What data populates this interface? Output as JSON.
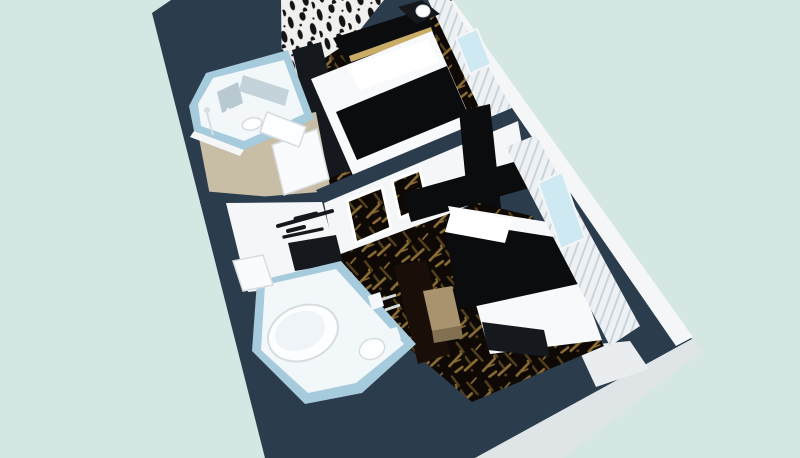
{
  "meta": {
    "description": "3D cutaway dollhouse rendering of a two-room hotel suite floor plan, viewed from above at an angle. No text is visible in the image.",
    "view": "aerial isometric cutaway",
    "width_px": 800,
    "height_px": 458
  },
  "palette": {
    "background": "#d4e7e2",
    "wall_top": "#2b3c4d",
    "slab_edge": "#dfe4e7",
    "notch_face": "#e9edef",
    "face_white": "#f4f6f8",
    "bathroom_wall": "#a6cbdc",
    "bathroom_floor": "#f2f7fa",
    "mirror": "#b9c9d1",
    "mirror_light": "#c4d3d9",
    "fixture_white": "#fdfeff",
    "fixture_line": "#d6dde1",
    "corridor_floor": "#c8bda5",
    "door_white": "#fafbfc",
    "door_edge": "#d8dde0",
    "carpet_base": "#0e0905",
    "carpet_motif1": "#8a6c34",
    "carpet_motif2": "#54401d",
    "wallpaper_bg": "#f0f0ee",
    "wallpaper_ink": "#141414",
    "bed_white": "#f7f9fa",
    "bed_black": "#0b0c0e",
    "pillow": "#ffffff",
    "trim_gold": "#c9ad67",
    "furniture_dark": "#15181c",
    "furniture_espresso": "#190f08",
    "stool_gray": "#23282d",
    "bench_tan_top": "#a8936e",
    "bench_tan_side": "#837050",
    "curtain": "#eef1f4",
    "curtain_line": "#c7d1d7",
    "window_glass": "#cfe9f2"
  },
  "scene": {
    "building": "two-room suite with dark navy wall tops and stepped lower-right corner",
    "rooms": [
      {
        "name": "guest room 1 (upper)",
        "floor": "black and gold patterned carpet",
        "wall_feature": "black-and-white birch patterned wallpaper",
        "furniture": [
          "bed with black runner and white linens",
          "black headboard with gold trim",
          "nightstand with white lamp",
          "dark wardrobe",
          "ottoman",
          "foot bench"
        ],
        "window": "curtained window on right wall"
      },
      {
        "name": "guest room 2 (lower)",
        "floor": "black and gold patterned carpet",
        "wall_feature": "black cross-shaped headboard art on divider wall, two framed prints, wall hanger rack, wall-mounted TV",
        "furniture": [
          "bed with black duvet and white foot blanket",
          "footboard bench",
          "espresso dresser",
          "tan luggage bench"
        ],
        "window": "curtained window on right wall"
      }
    ],
    "bathrooms": [
      {
        "name": "bathroom 1 (upper left)",
        "walls": "pale blue",
        "fixtures": [
          "vanity mirror",
          "sink",
          "tub",
          "shower"
        ]
      },
      {
        "name": "bathroom 2 (lower center)",
        "walls": "pale blue",
        "fixtures": [
          "large oval tub",
          "toilet",
          "shower fittings"
        ]
      }
    ],
    "corridor": "beige entry corridor with white doors"
  }
}
